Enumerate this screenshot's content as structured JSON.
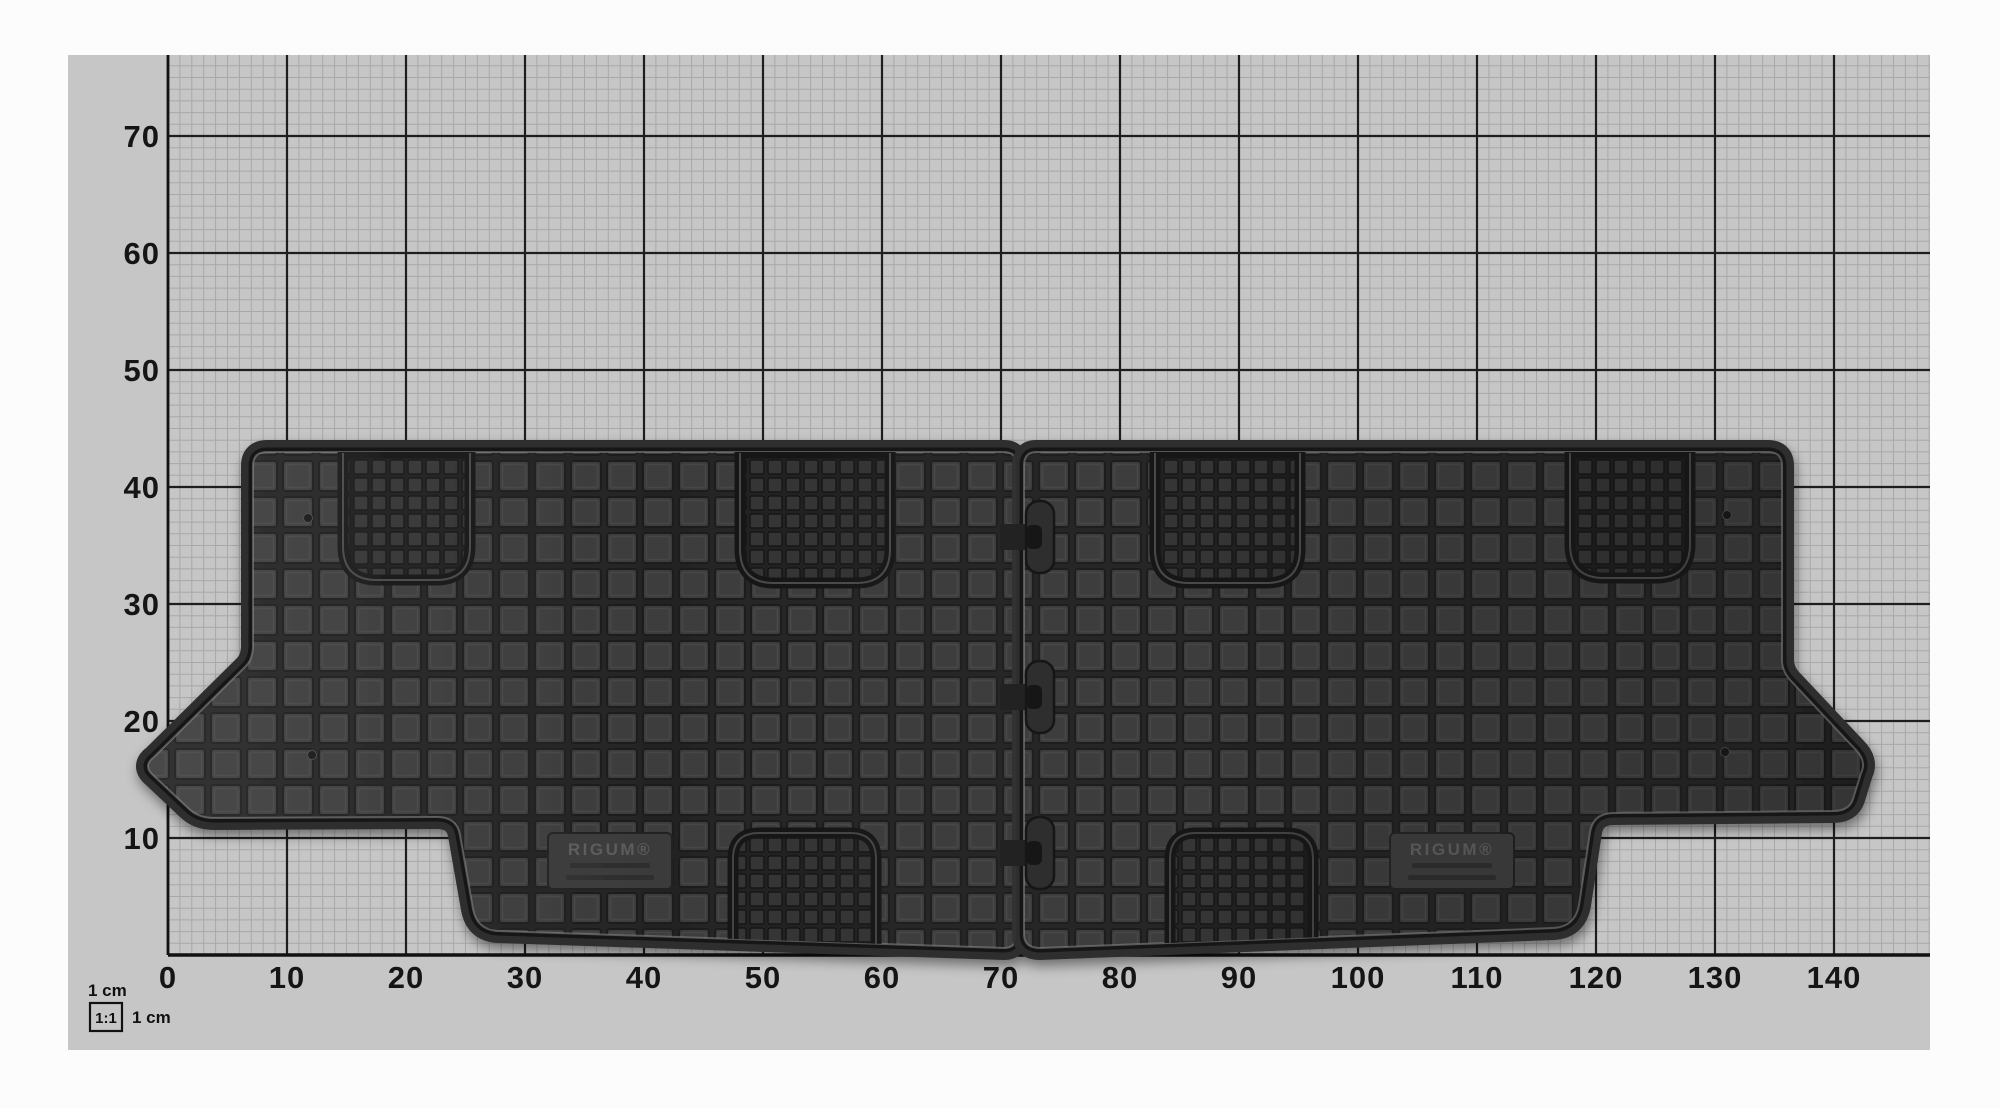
{
  "photo": {
    "subject": "Two-piece black rubber car floor mat photographed on centimetre grid paper",
    "mat": {
      "brand": "RIGUM®",
      "pieces": 2
    }
  },
  "ruler": {
    "unit": "cm",
    "x_labels": [
      "0",
      "10",
      "20",
      "30",
      "40",
      "50",
      "60",
      "70",
      "80",
      "90",
      "100",
      "110",
      "120",
      "130",
      "140"
    ],
    "y_labels": [
      "70",
      "60",
      "50",
      "40",
      "30",
      "20",
      "10"
    ]
  },
  "scale_indicator": {
    "top_label": "1 cm",
    "ratio_label": "1:1",
    "side_label": "1 cm"
  },
  "colors": {
    "page_bg": "#fcfcfc",
    "paper": "#c6c6c6",
    "grid_minor": "#a8a8a8",
    "grid_major": "#1e1e1e",
    "axis_text": "#151515",
    "mat_block": "#3c3c3c",
    "mat_groove": "#242424",
    "mat_rim": "#161616"
  }
}
